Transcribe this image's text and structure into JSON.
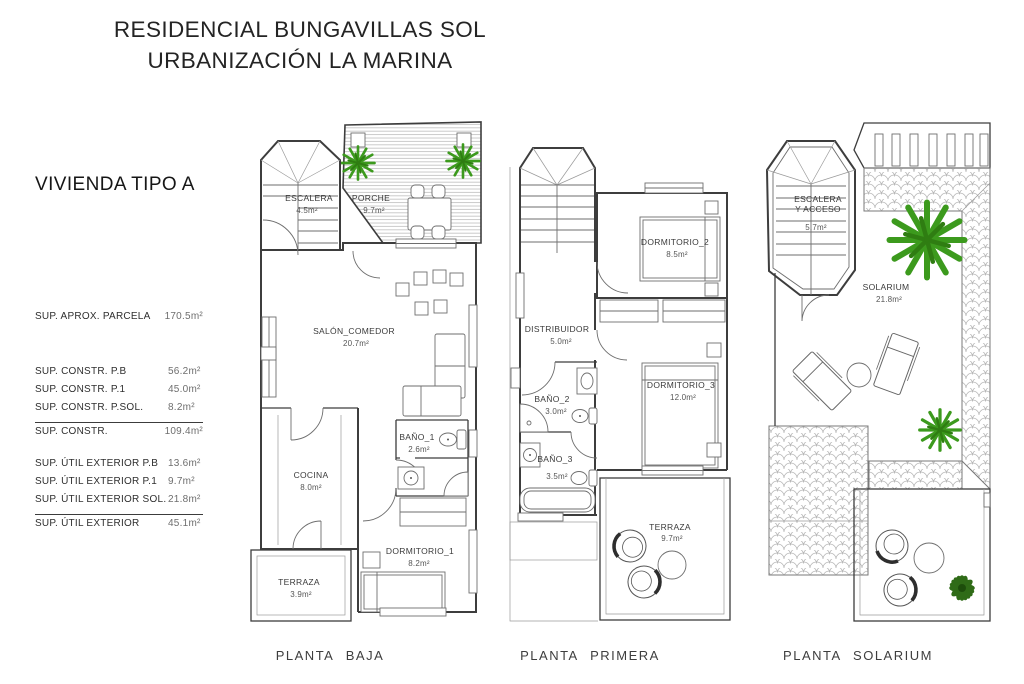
{
  "header": {
    "line1": "RESIDENCIAL BUNGAVILLAS SOL",
    "line2": "URBANIZACIÓN LA MARINA"
  },
  "sidebar": {
    "heading": "VIVIENDA TIPO A",
    "parcela": {
      "label": "SUP.  APROX.  PARCELA",
      "value": "170.5m²"
    },
    "constr": [
      {
        "label": "SUP.  CONSTR.  P.B",
        "value": "56.2m²"
      },
      {
        "label": "SUP.  CONSTR.  P.1",
        "value": "45.0m²"
      },
      {
        "label": "SUP.  CONSTR.  P.SOL.",
        "value": "8.2m²"
      },
      {
        "label": "SUP.  CONSTR.",
        "value": "109.4m²"
      }
    ],
    "util": [
      {
        "label": "SUP.  ÚTIL  EXTERIOR  P.B",
        "value": "13.6m²"
      },
      {
        "label": "SUP.  ÚTIL  EXTERIOR  P.1",
        "value": "9.7m²"
      },
      {
        "label": "SUP.  ÚTIL  EXTERIOR  SOL.",
        "value": "21.8m²"
      },
      {
        "label": "SUP.  ÚTIL  EXTERIOR",
        "value": "45.1m²"
      }
    ]
  },
  "plans": [
    {
      "caption": "PLANTA  BAJA",
      "rooms": {
        "escalera": {
          "name": "ESCALERA",
          "area": "4.5m²"
        },
        "porche": {
          "name": "PORCHE",
          "area": "9.7m²"
        },
        "salon": {
          "name": "SALÓN_COMEDOR",
          "area": "20.7m²"
        },
        "bano1": {
          "name": "BAÑO_1",
          "area": "2.6m²"
        },
        "cocina": {
          "name": "COCINA",
          "area": "8.0m²"
        },
        "dormitorio1": {
          "name": "DORMITORIO_1",
          "area": "8.2m²"
        },
        "terraza": {
          "name": "TERRAZA",
          "area": "3.9m²"
        }
      }
    },
    {
      "caption": "PLANTA  PRIMERA",
      "rooms": {
        "dormitorio2": {
          "name": "DORMITORIO_2",
          "area": "8.5m²"
        },
        "distribuidor": {
          "name": "DISTRIBUIDOR",
          "area": "5.0m²"
        },
        "bano2": {
          "name": "BAÑO_2",
          "area": "3.0m²"
        },
        "dormitorio3": {
          "name": "DORMITORIO_3",
          "area": "12.0m²"
        },
        "bano3": {
          "name": "BAÑO_3",
          "area": "3.5m²"
        },
        "terraza": {
          "name": "TERRAZA",
          "area": "9.7m²"
        }
      }
    },
    {
      "caption": "PLANTA  SOLARIUM",
      "rooms": {
        "escalera": {
          "line1": "ESCALERA",
          "line2": "Y  ACCESO",
          "area": "5.7m²"
        },
        "solarium": {
          "name": "SOLARIUM",
          "area": "21.8m²"
        }
      }
    }
  ],
  "colors": {
    "wall": "#3d3d3d",
    "hatch": "#b9b9b9",
    "plant_green": "#3c9a1d",
    "plant_dark": "#2f6b17",
    "text": "#3a3a3a"
  }
}
